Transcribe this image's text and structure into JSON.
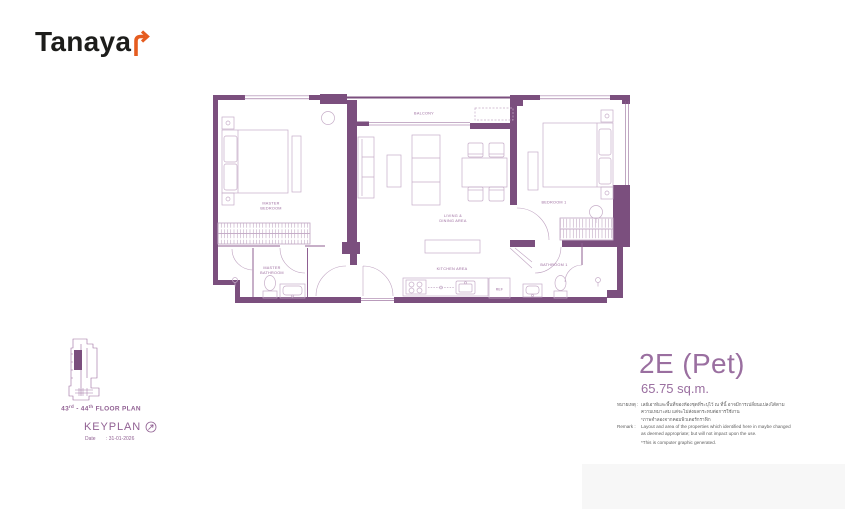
{
  "brand": {
    "logo_text": "Tanaya",
    "logo_full": "Tanayar",
    "arrow_color": "#e55c1f"
  },
  "unit": {
    "name": "2E (Pet)",
    "area": "65.75 sq.m."
  },
  "floor_plan": {
    "labels": {
      "master_bedroom_l1": "MASTER",
      "master_bedroom_l2": "BEDROOM",
      "balcony": "BALCONY",
      "living_l1": "LIVING &",
      "living_l2": "DINING AREA",
      "kitchen": "KITCHEN AREA",
      "bedroom1": "BEDROOM 1",
      "bathroom1": "BATHROOM 1",
      "master_bathroom_l1": "MASTER",
      "master_bathroom_l2": "BATHROOM",
      "ref": "REF"
    },
    "colors": {
      "wall": "#7b4f7e",
      "partition": "#8f5f92",
      "furniture": "#c6adc8",
      "label": "#9c6b9e"
    }
  },
  "keyplan": {
    "floor_line": {
      "num1": "43",
      "sup1": "rd",
      "num2": "- 44",
      "sup2": "th",
      "suffix": "FLOOR PLAN"
    },
    "title": "KEYPLAN",
    "date_label": "Date",
    "date_value": ": 31-01-2026"
  },
  "disclaimer": {
    "thai_label": "หมายเหตุ :",
    "thai_text": "เลย์เอาท์และพื้นที่ของห้องชุดที่ระบุไว้ ณ ที่นี้ อาจมีการเปลี่ยนแปลงได้ตามความเหมาะสม แต่จะไม่ส่งผลกระทบต่อการใช้งาน",
    "thai_note": "*ภาพจำลองจากคอมพิวเตอร์กราฟิก",
    "remark_label": "Remark :",
    "remark_text": "Layout and area of the properties which identified here in maybe changed as deemed appropriate; but will not impact upon the use.",
    "remark_note": "*This is computer graphic generated."
  }
}
